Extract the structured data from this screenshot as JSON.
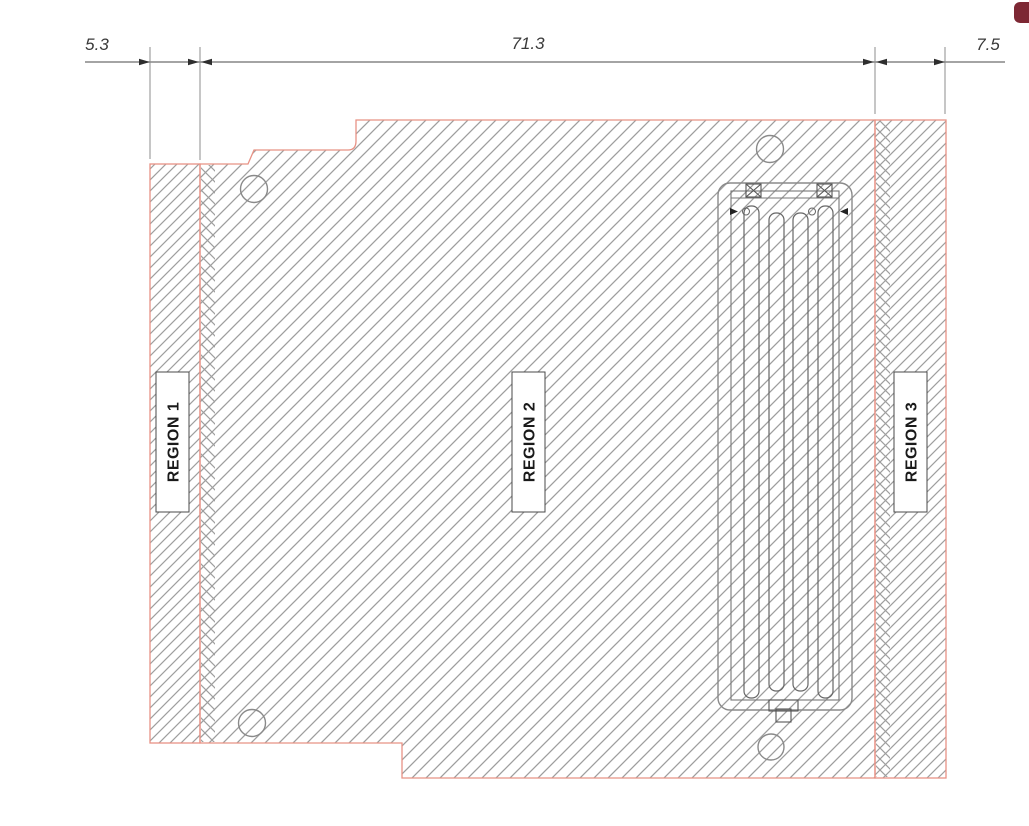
{
  "drawing": {
    "dimension_labels": {
      "left": "5.3",
      "middle": "71.3",
      "right": "7.5"
    },
    "region_labels": {
      "r1": "REGION 1",
      "r2": "REGION 2",
      "r3": "REGION 3"
    },
    "colors": {
      "part_outline": "#e89285",
      "hatch_line": "#9e9e9e",
      "dimension_line": "#6e6e6e",
      "dimension_text": "#3a3a3a",
      "corner_badge": "#7d2834",
      "background": "#ffffff"
    }
  }
}
